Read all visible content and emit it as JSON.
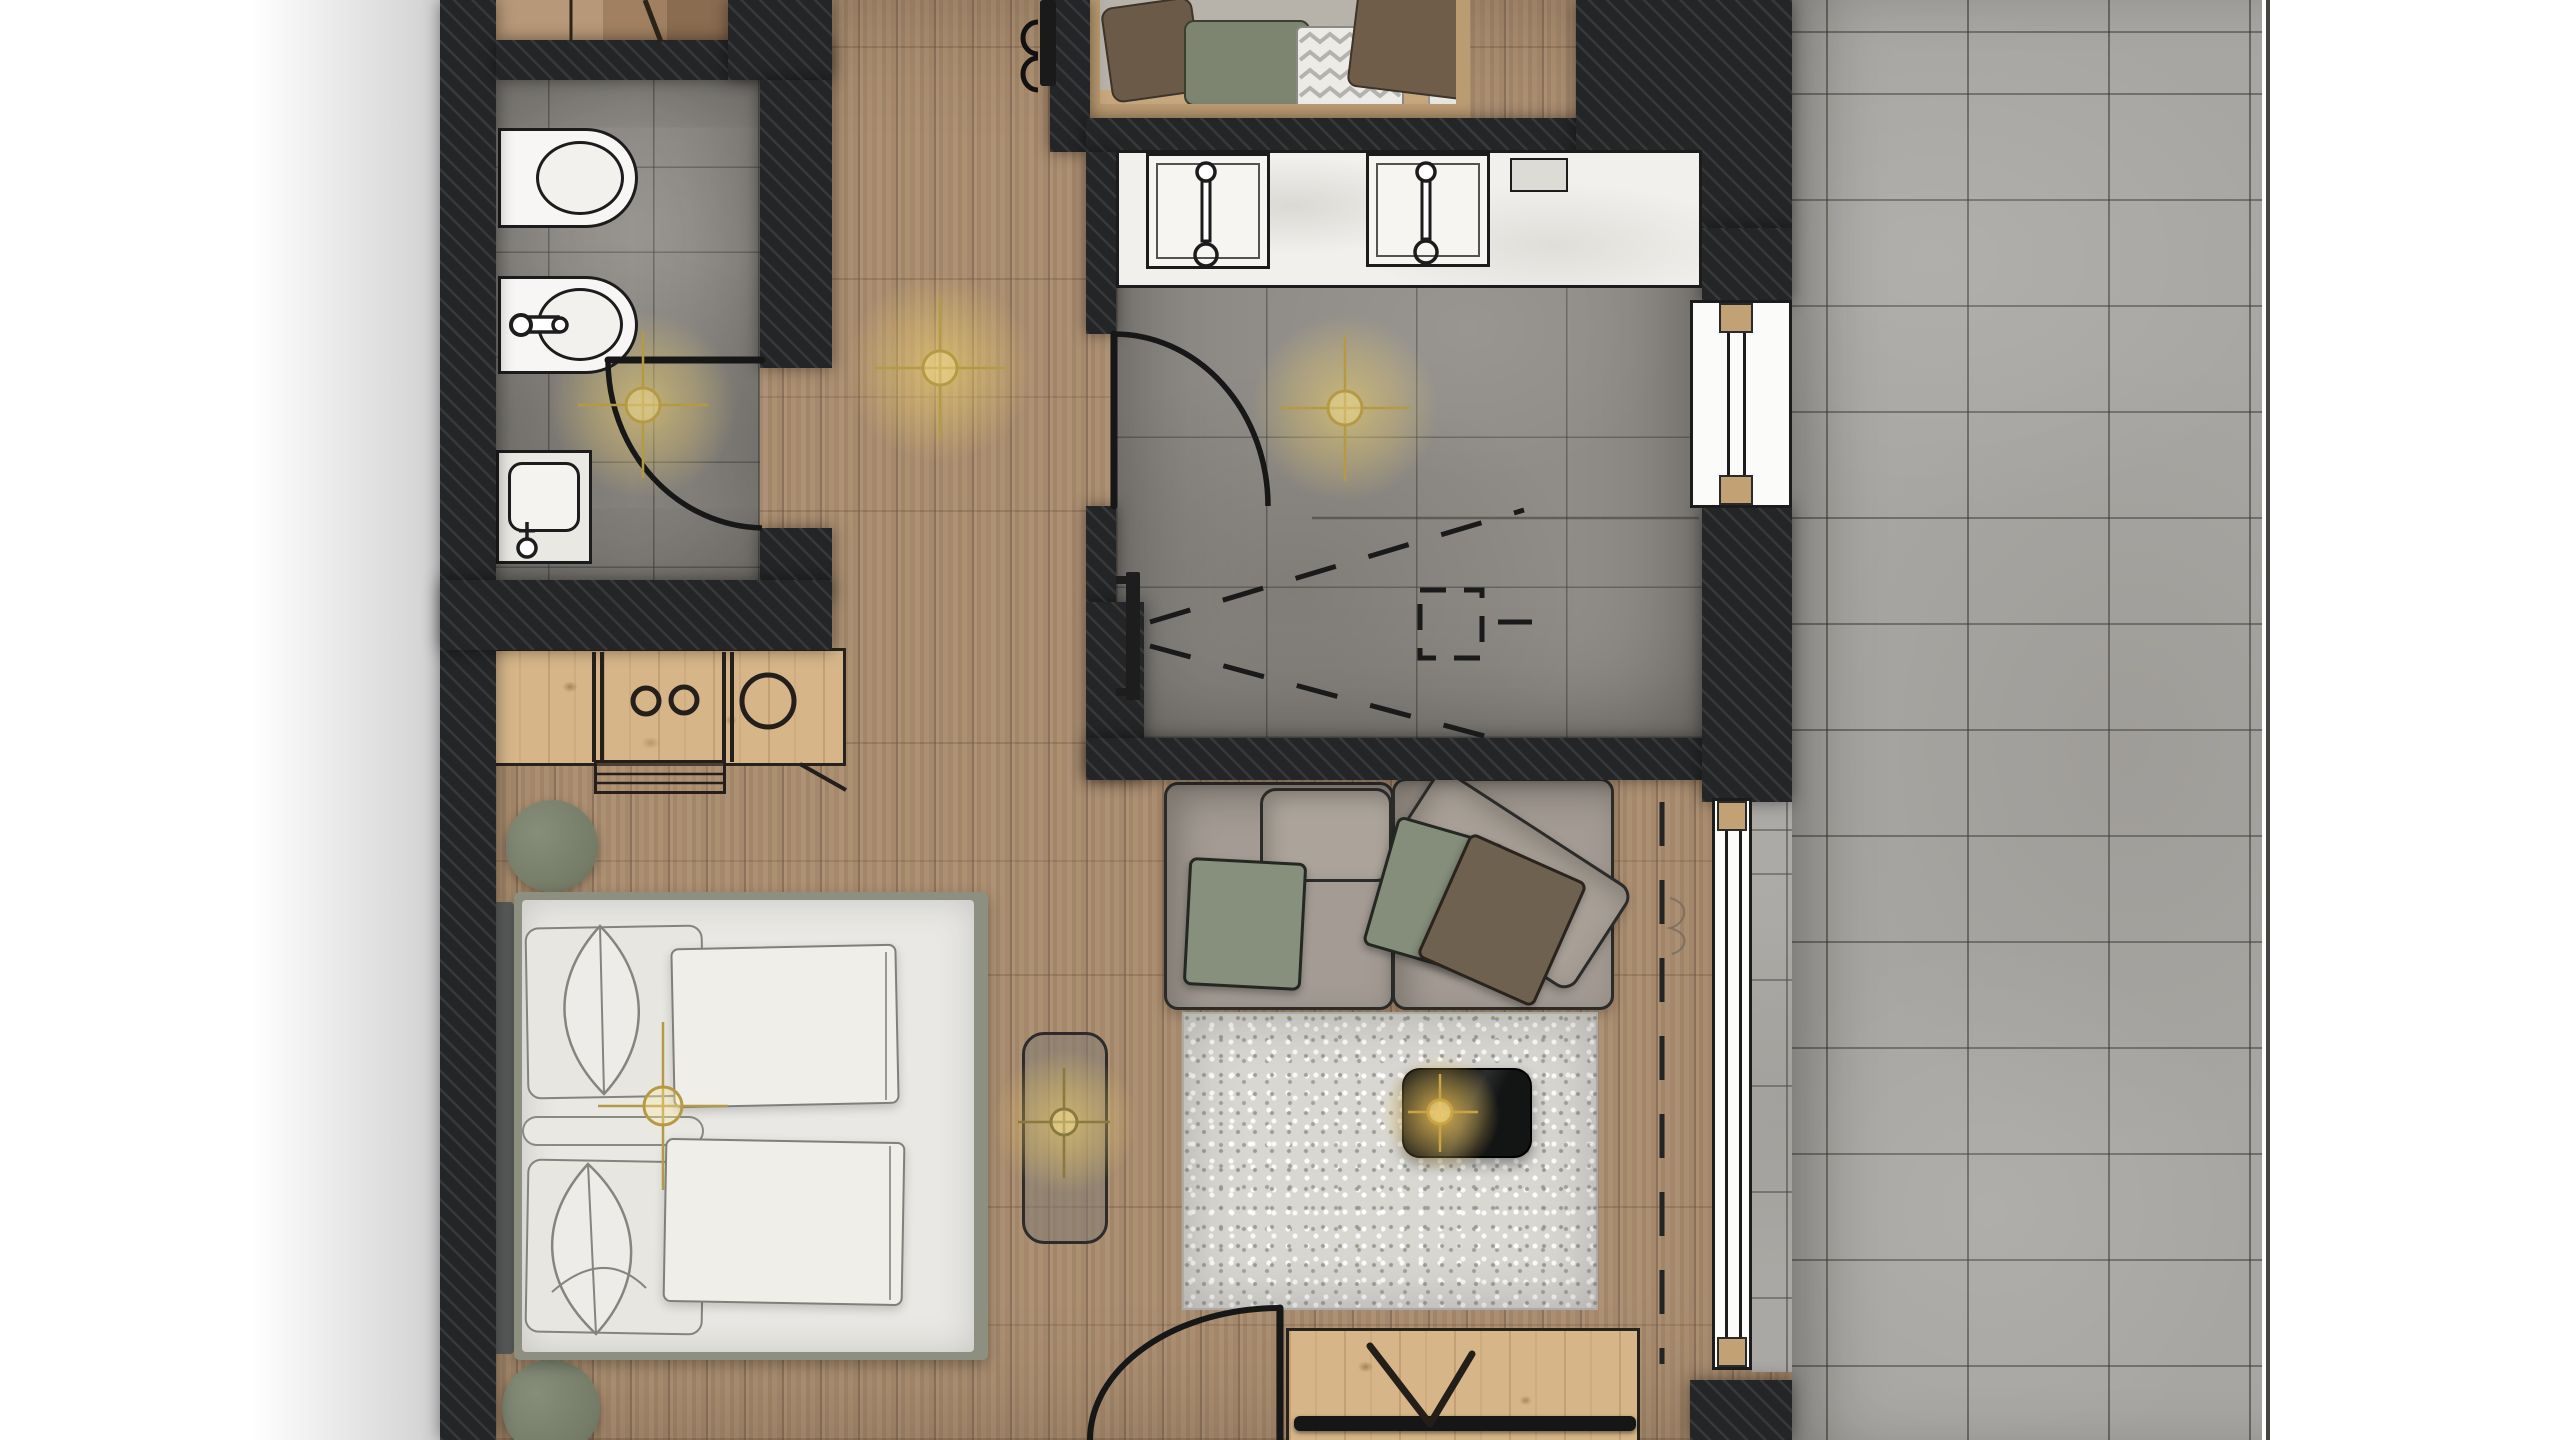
{
  "plan": {
    "type": "architectural-floor-plan-render",
    "view": "top-down",
    "visible_text": [],
    "rooms": [
      {
        "name": "wc-bathroom",
        "floor": "grey-tile",
        "items": [
          "wall-hung-toilet",
          "bidet-with-faucet",
          "washbasin-counter",
          "ceiling-light",
          "hinged-door"
        ]
      },
      {
        "name": "shower-bathroom",
        "floor": "grey-tile",
        "items": [
          "double-vanity-counter",
          "sink-left",
          "sink-right",
          "wall-niche",
          "shower-linear-drain-bar",
          "shower-spray-dashed-lines",
          "floor-drain-dashed-square",
          "ceiling-light",
          "hinged-door",
          "window-to-terrace"
        ]
      },
      {
        "name": "entry-hallway",
        "floor": "oak-planks",
        "items": [
          "coat-rail",
          "coat-hooks",
          "ceiling-light",
          "entrance-door"
        ]
      },
      {
        "name": "wardrobe-niche",
        "floor": "wood-shelf",
        "items": [
          "brown-pillow",
          "green-cushion-stack",
          "zigzag-towel-stack",
          "brown-blanket",
          "white-duvet-roll"
        ]
      },
      {
        "name": "bedroom",
        "floor": "oak-planks",
        "items": [
          "double-bed",
          "headboard",
          "pillow-top",
          "pillow-bottom",
          "leaf-accent-pillow-top",
          "leaf-accent-pillow-bottom",
          "duvet-top",
          "duvet-bottom",
          "round-pouf-upper",
          "round-pouf-lower",
          "minibar-counter",
          "counter-circles",
          "bench-chair",
          "pendant-light"
        ]
      },
      {
        "name": "living-area",
        "floor": "oak-planks",
        "items": [
          "modular-sofa",
          "seat-cushion-back",
          "lounge-cushion-rotated",
          "green-pillow-left",
          "green-pillow-right",
          "brown-pillow-right",
          "shaggy-rug",
          "dark-coffee-table",
          "glowing-table-light",
          "foot-bench-with-pendant",
          "tv-sideboard",
          "tv-on-v-stand",
          "sliding-glass-door",
          "sliding-track-dashes"
        ]
      },
      {
        "name": "terrace",
        "floor": "stone-tiles",
        "items": [
          "tile-grid",
          "slab-edge-line"
        ]
      }
    ],
    "lights_count": 6,
    "doors_count": 3,
    "windows_count": 2
  },
  "palette": {
    "wall": "#232526",
    "woodFloor": "#a98c6e",
    "tileFloor": "#908d88",
    "terrace": "#a8a6a2",
    "pine": "#d6b689",
    "marble": "#f1f0ec",
    "fixtureWhite": "#f7f6f4",
    "outline": "#1c1c1c",
    "sofa": "#a49c94",
    "sofaCushion": "#aca49b",
    "pillowGreen": "#87907c",
    "pillowBrown": "#6e6150",
    "bedFrame": "#8d9080",
    "mattress": "#e9e8e4",
    "headboard": "#5c5e5d",
    "pouf": "#7b8370",
    "rug": "#d8d7d2",
    "tableDark": "#1c1d1d",
    "lightGlow": "#e8c95f",
    "lightLine": "#b59a45",
    "glassWhite": "#fbfbfa",
    "windowWood": "#c2a174",
    "closetShelf": "#b7b3aa",
    "closetWood": "#bb9b72"
  }
}
